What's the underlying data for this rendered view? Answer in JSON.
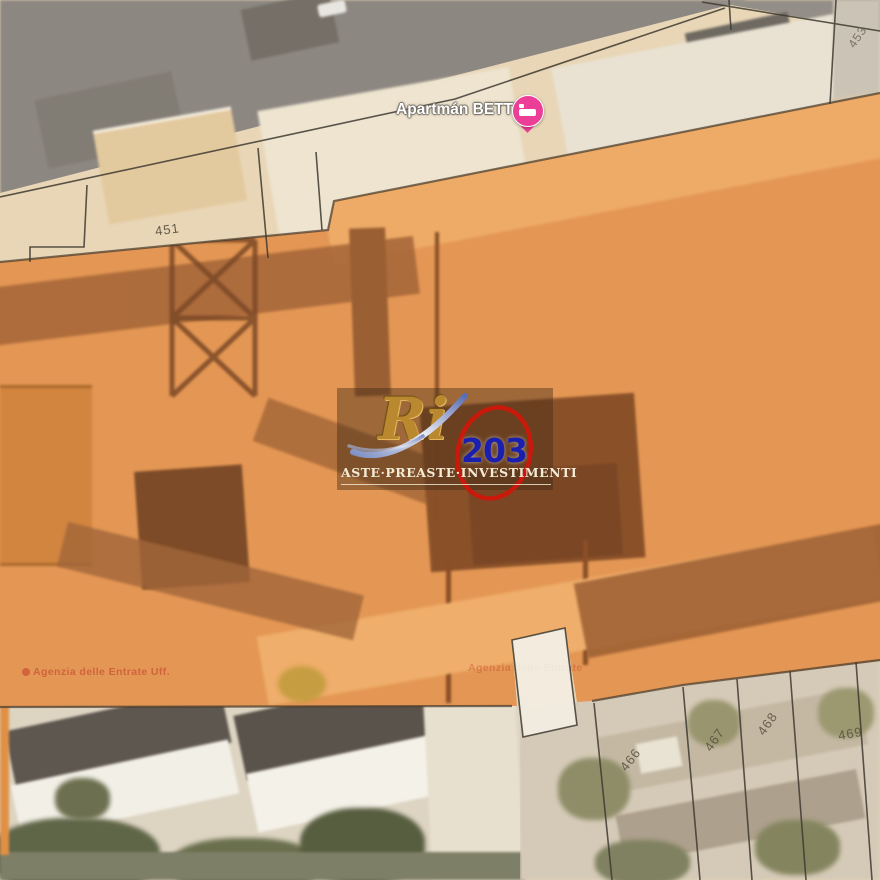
{
  "map": {
    "poi": {
      "label": "Apartmán BETTY",
      "icon": "lodging-pin-icon"
    },
    "agency_left": "Agenzia delle Entrate Uff.",
    "agency_right": "Agenzia delle Entrate",
    "parcels": {
      "p451": "451",
      "p453": "453",
      "p466": "466",
      "p467": "467",
      "p468": "468",
      "p469": "469"
    }
  },
  "watermark": {
    "logo": "Ri",
    "number": "203",
    "brand": "ASTE·PREASTE·INVESTIMENTI"
  },
  "colors": {
    "overlay_orange": "#E8913E",
    "pin_pink": "#EC3E96",
    "watermark_red": "#D0160A",
    "watermark_blue": "#1B1FB0",
    "watermark_gold": "#B9882F",
    "boundary_line": "#3F3A31"
  }
}
